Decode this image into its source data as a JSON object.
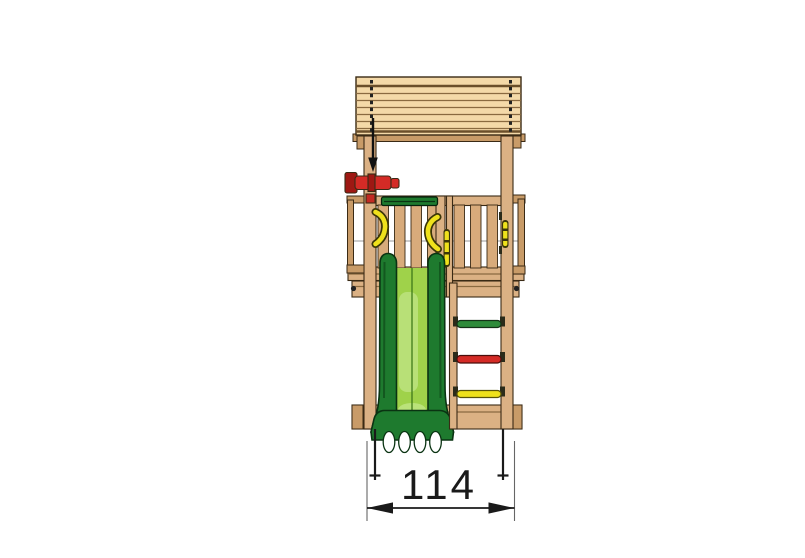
{
  "dimension": {
    "label": "114"
  },
  "colors": {
    "wood": "#DBB184",
    "wood_slat": "#D8AB7B",
    "wood_dark": "#C89B68",
    "roof": "#F4D9A8",
    "roof_line": "#8A6A40",
    "roof_line_dark": "#6B4F2A",
    "outline": "#3A2A15",
    "slide_rail": "#1E7A2E",
    "slide_rail_dark": "#0A3312",
    "slide_bed": "#9FD24A",
    "slide_bed_light": "#BCE37F",
    "handle_yellow": "#EFE11C",
    "handle_dark": "#3B3608",
    "telescope_red": "#D42B26",
    "telescope_dark": "#9E1813",
    "entry_bar_green": "#1E7A2E",
    "dim": "#1A1A1A",
    "ext_line": "#666666"
  },
  "ladder": {
    "rungs": [
      {
        "name": "top-rung",
        "color": "#2E8B3A"
      },
      {
        "name": "middle-rung",
        "color": "#D42B26"
      },
      {
        "name": "bottom-rung",
        "color": "#EFE11C"
      }
    ]
  }
}
